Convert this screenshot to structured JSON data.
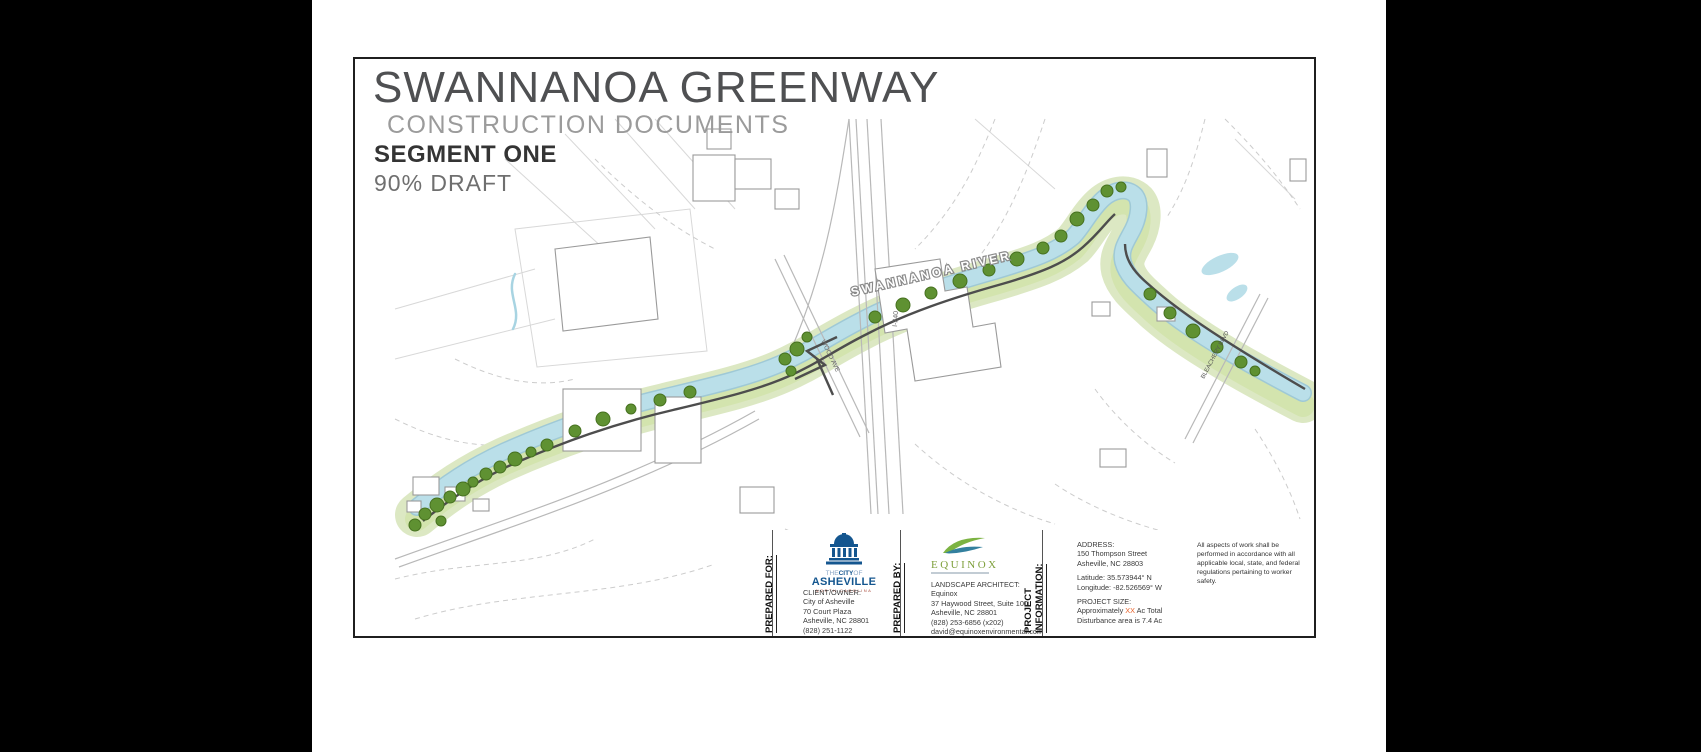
{
  "title_block": {
    "project_title": "SWANNANOA GREENWAY",
    "document_type": "CONSTRUCTION DOCUMENTS",
    "segment": "SEGMENT ONE",
    "draft_status": "90% DRAFT"
  },
  "map": {
    "river_label": "SWANNANOA RIVER",
    "road_labels": {
      "wood_ave": "WOOD AVE",
      "i240": "I-240",
      "bleachery": "BLEACHERY BLVD"
    }
  },
  "title_strip": {
    "prepared_for": {
      "heading": "PREPARED FOR:",
      "logo": {
        "the": "THE",
        "city": "CITY",
        "of": "OF",
        "name": "ASHEVILLE",
        "state": "NORTH CAROLINA"
      },
      "client_label": "CLIENT/OWNER:",
      "client_lines": [
        "City of Asheville",
        "70 Court Plaza",
        "Asheville, NC 28801",
        "(828) 251-1122"
      ]
    },
    "prepared_by": {
      "heading": "PREPARED BY:",
      "logo_text": "EQUINOX",
      "role_label": "LANDSCAPE ARCHITECT:",
      "lines": [
        "Equinox",
        "37 Haywood Street, Suite 100",
        "Asheville, NC 28801",
        "(828) 253-6856 (x202)",
        "david@equinoxenvironmental.com"
      ]
    },
    "project_information": {
      "heading_line1": "PROJECT",
      "heading_line2": "INFORMATION:",
      "address_label": "ADDRESS:",
      "address_lines": [
        "150 Thompson Street",
        "Asheville, NC 28803"
      ],
      "latitude": "Latitude:  35.573944° N",
      "longitude": "Longitude: -82.526569° W",
      "size_label": "PROJECT SIZE:",
      "size_prefix": "Approximately ",
      "size_value_placeholder": "XX",
      "size_suffix": " Ac Total",
      "size_line2": "Disturbance area is 7.4 Ac"
    },
    "safety_note": "All aspects of work shall be performed in accordance with all applicable local, state, and federal regulations pertaining to worker safety."
  },
  "colors": {
    "accent_blue": "#14568f",
    "equinox_green": "#7d9f3a",
    "river_blue": "#badfe9",
    "corridor_green": "#dce8c3",
    "tree_green": "#5f9132",
    "trail_gray": "#4d4d4d",
    "placeholder_orange": "#e8622a"
  }
}
